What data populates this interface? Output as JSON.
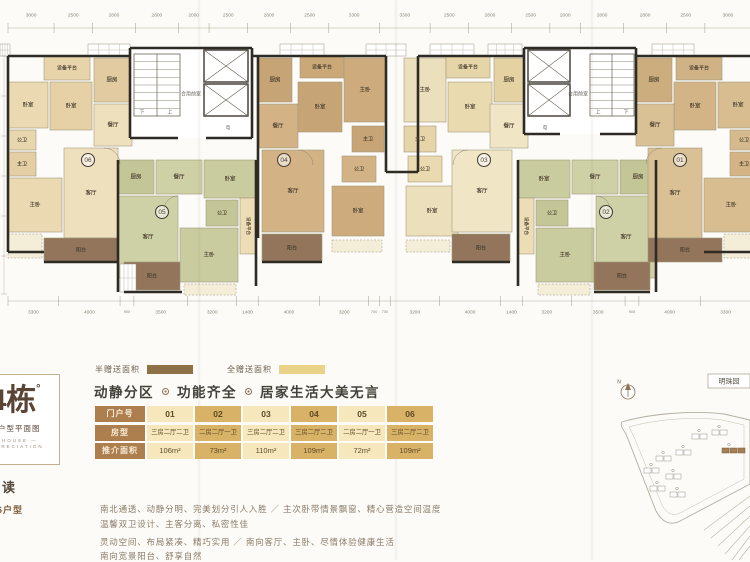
{
  "palette": {
    "accent_brown": "#ad7f4e",
    "table_light": "#f6e7bd",
    "table_dark": "#d8b266",
    "legend_half": "#8f7147",
    "legend_full": "#ead388",
    "balcony": "#92755a",
    "wall": "#2e2a24"
  },
  "legend": {
    "half_label": "半赠送面积",
    "full_label": "全赠送面积"
  },
  "headline": {
    "part1": "动静分区",
    "part2": "功能齐全",
    "part3": "居家生活大美无言"
  },
  "table": {
    "rows": [
      {
        "label": "门户号",
        "cls": "r-no",
        "cells": [
          "01",
          "02",
          "03",
          "04",
          "05",
          "06"
        ]
      },
      {
        "label": "房型",
        "cls": "r-type",
        "cells": [
          "三房二厅二卫",
          "二房二厅一卫",
          "三房二厅二卫",
          "三房二厅二卫",
          "二房二厅一卫",
          "三房二厅二卫"
        ]
      },
      {
        "label": "推介面积",
        "cls": "r-area",
        "cells": [
          "106m²",
          "73m²",
          "110m²",
          "109m²",
          "72m²",
          "109m²"
        ]
      }
    ]
  },
  "logo": {
    "building": "4栋",
    "degree": "°",
    "subtitle": "层户型平面图",
    "en1": "— HOUSE —",
    "en2": "APPRECIATION"
  },
  "notes": {
    "title": "解读",
    "label": "06户型",
    "p1l1": "南北通透、动静分明、完美划分引人入胜 ／ 主次卧带情景飘窗、精心营造空间温度",
    "p1l2": "温馨双卫设计、主客分离、私密性佳",
    "p2l1": "灵动空间、布局紧凑、精巧实用 ／ 南向客厅、主卧、尽情体验健康生活",
    "p2l2": "南向宽景阳台、舒享自然"
  },
  "sitemap": {
    "label": "明珠园",
    "north": "N",
    "outer": "M10,54 C36,46 80,42 112,46 L138,52 L138,116 L70,152 C58,159 50,154 44,143 L14,66 C10,60 8,57 10,54 Z",
    "inner": "M17,59 C40,52 80,48 110,52 L132,57 L132,111 L70,144 C61,149 55,146 50,137 L22,69 Z",
    "roads": [
      [
        92,
        162,
        138,
        128
      ],
      [
        99,
        170,
        138,
        138
      ],
      [
        106,
        178,
        138,
        148
      ],
      [
        113,
        186,
        138,
        158
      ],
      [
        120,
        192,
        138,
        168
      ],
      [
        127,
        192,
        138,
        178
      ]
    ],
    "buildings": [
      {
        "x": 100,
        "y": 62
      },
      {
        "x": 80,
        "y": 66
      },
      {
        "x": 64,
        "y": 82
      },
      {
        "x": 44,
        "y": 88
      },
      {
        "x": 32,
        "y": 100
      },
      {
        "x": 54,
        "y": 106
      },
      {
        "x": 38,
        "y": 118
      },
      {
        "x": 58,
        "y": 124
      },
      {
        "x": 110,
        "y": 80,
        "hl": true
      }
    ],
    "labelbox": {
      "x": 96,
      "y": 6,
      "w": 42,
      "h": 14
    },
    "compass": {
      "cx": 16,
      "cy": 24,
      "r": 7
    }
  },
  "plan": {
    "dims_top": [
      3000,
      2500,
      2800,
      2800,
      2000,
      2500,
      2800,
      2500,
      3300,
      3300,
      2500,
      2800,
      2500,
      2000,
      2800,
      2800,
      2500,
      3000
    ],
    "dims_bottom": [
      3300,
      4000,
      900,
      3500,
      3200,
      1400,
      4000,
      3200,
      700,
      700,
      3200,
      4000,
      1400,
      3200,
      3500,
      900,
      4000,
      3300
    ],
    "rooms": [
      {
        "t": "设备平台",
        "x": 44,
        "y": 56,
        "w": 46,
        "h": 24,
        "f": "#e7d4ab",
        "fs": 5
      },
      {
        "t": "卧室",
        "x": 8,
        "y": 82,
        "w": 40,
        "h": 46,
        "f": "#ebd9b2"
      },
      {
        "t": "卧室",
        "x": 50,
        "y": 82,
        "w": 42,
        "h": 48,
        "f": "#e6d1a6"
      },
      {
        "t": "厨房",
        "x": 94,
        "y": 58,
        "w": 36,
        "h": 44,
        "f": "#e2cba0"
      },
      {
        "t": "餐厅",
        "x": 94,
        "y": 104,
        "w": 38,
        "h": 42,
        "f": "#efe0bd"
      },
      {
        "t": "公卫",
        "x": 8,
        "y": 130,
        "w": 28,
        "h": 20,
        "f": "#e8d6ae",
        "fs": 5
      },
      {
        "t": "主卫",
        "x": 8,
        "y": 152,
        "w": 28,
        "h": 24,
        "f": "#e4cfa4",
        "fs": 5
      },
      {
        "t": "主卧",
        "x": 8,
        "y": 178,
        "w": 54,
        "h": 54,
        "f": "#ebd9b2"
      },
      {
        "t": "客厅",
        "x": 64,
        "y": 148,
        "w": 54,
        "h": 90,
        "f": "#efe0bd"
      },
      {
        "t": "阳台",
        "x": 44,
        "y": 238,
        "w": 74,
        "h": 24,
        "f": "#92755a",
        "fs": 5
      },
      {
        "t": "厨房",
        "x": 118,
        "y": 160,
        "w": 36,
        "h": 34,
        "f": "#c3c697"
      },
      {
        "t": "餐厅",
        "x": 156,
        "y": 160,
        "w": 46,
        "h": 34,
        "f": "#ced1a5"
      },
      {
        "t": "卧室",
        "x": 204,
        "y": 160,
        "w": 52,
        "h": 38,
        "f": "#c9cc9f"
      },
      {
        "t": "公卫",
        "x": 206,
        "y": 200,
        "w": 32,
        "h": 26,
        "f": "#c3c697",
        "fs": 5
      },
      {
        "t": "客厅",
        "x": 118,
        "y": 196,
        "w": 60,
        "h": 82,
        "f": "#ced1a5"
      },
      {
        "t": "主卧",
        "x": 180,
        "y": 228,
        "w": 58,
        "h": 54,
        "f": "#c9cc9f"
      },
      {
        "t": "设备平台",
        "x": 240,
        "y": 198,
        "w": 16,
        "h": 56,
        "f": "#ecddb6",
        "fs": 4.5,
        "rot": 90
      },
      {
        "t": "阳台",
        "x": 124,
        "y": 262,
        "w": 56,
        "h": 28,
        "f": "#92755a",
        "fs": 5
      },
      {
        "t": "厨房",
        "x": 258,
        "y": 58,
        "w": 34,
        "h": 44,
        "f": "#c7a476"
      },
      {
        "t": "餐厅",
        "x": 258,
        "y": 104,
        "w": 40,
        "h": 44,
        "f": "#d3b386"
      },
      {
        "t": "设备平台",
        "x": 300,
        "y": 56,
        "w": 44,
        "h": 22,
        "f": "#caa878",
        "fs": 5
      },
      {
        "t": "卧室",
        "x": 298,
        "y": 82,
        "w": 44,
        "h": 50,
        "f": "#c7a476"
      },
      {
        "t": "主卧",
        "x": 344,
        "y": 58,
        "w": 42,
        "h": 64,
        "f": "#cdab7d"
      },
      {
        "t": "主卫",
        "x": 352,
        "y": 126,
        "w": 32,
        "h": 26,
        "f": "#c7a476",
        "fs": 5
      },
      {
        "t": "公卫",
        "x": 342,
        "y": 156,
        "w": 34,
        "h": 26,
        "f": "#d3b386",
        "fs": 5
      },
      {
        "t": "卧室",
        "x": 332,
        "y": 186,
        "w": 52,
        "h": 50,
        "f": "#cdab7d"
      },
      {
        "t": "客厅",
        "x": 262,
        "y": 150,
        "w": 62,
        "h": 82,
        "f": "#d3b386"
      },
      {
        "t": "阳台",
        "x": 262,
        "y": 234,
        "w": 60,
        "h": 28,
        "f": "#92755a",
        "fs": 5
      },
      {
        "t": "主卧",
        "x": 404,
        "y": 58,
        "w": 42,
        "h": 64,
        "f": "#ece0bc"
      },
      {
        "t": "设备平台",
        "x": 446,
        "y": 56,
        "w": 44,
        "h": 22,
        "f": "#e6d5a8",
        "fs": 5
      },
      {
        "t": "卧室",
        "x": 448,
        "y": 82,
        "w": 44,
        "h": 50,
        "f": "#e9dab0"
      },
      {
        "t": "厨房",
        "x": 494,
        "y": 58,
        "w": 30,
        "h": 44,
        "f": "#e4d2a3"
      },
      {
        "t": "餐厅",
        "x": 490,
        "y": 104,
        "w": 38,
        "h": 44,
        "f": "#f0e6c6"
      },
      {
        "t": "主卫",
        "x": 404,
        "y": 126,
        "w": 32,
        "h": 26,
        "f": "#e6d5a8",
        "fs": 5
      },
      {
        "t": "公卫",
        "x": 408,
        "y": 156,
        "w": 34,
        "h": 26,
        "f": "#e9dab0",
        "fs": 5
      },
      {
        "t": "卧室",
        "x": 406,
        "y": 186,
        "w": 52,
        "h": 50,
        "f": "#ece0bc"
      },
      {
        "t": "客厅",
        "x": 452,
        "y": 150,
        "w": 60,
        "h": 82,
        "f": "#f0e6c6"
      },
      {
        "t": "阳台",
        "x": 452,
        "y": 234,
        "w": 58,
        "h": 28,
        "f": "#92755a",
        "fs": 5
      },
      {
        "t": "卧室",
        "x": 518,
        "y": 160,
        "w": 52,
        "h": 38,
        "f": "#c9cc9f"
      },
      {
        "t": "餐厅",
        "x": 572,
        "y": 160,
        "w": 46,
        "h": 34,
        "f": "#ced1a5"
      },
      {
        "t": "厨房",
        "x": 620,
        "y": 160,
        "w": 36,
        "h": 34,
        "f": "#c3c697"
      },
      {
        "t": "公卫",
        "x": 536,
        "y": 200,
        "w": 32,
        "h": 26,
        "f": "#c3c697",
        "fs": 5
      },
      {
        "t": "主卧",
        "x": 536,
        "y": 228,
        "w": 58,
        "h": 54,
        "f": "#c9cc9f"
      },
      {
        "t": "客厅",
        "x": 596,
        "y": 196,
        "w": 60,
        "h": 82,
        "f": "#ced1a5"
      },
      {
        "t": "设备平台",
        "x": 518,
        "y": 198,
        "w": 16,
        "h": 56,
        "f": "#ecddb6",
        "fs": 4.5,
        "rot": 90
      },
      {
        "t": "阳台",
        "x": 594,
        "y": 262,
        "w": 56,
        "h": 28,
        "f": "#92755a",
        "fs": 5
      },
      {
        "t": "设备平台",
        "x": 676,
        "y": 56,
        "w": 46,
        "h": 24,
        "f": "#cfb285",
        "fs": 5
      },
      {
        "t": "卧室",
        "x": 718,
        "y": 82,
        "w": 40,
        "h": 46,
        "f": "#d7bd90"
      },
      {
        "t": "卧室",
        "x": 674,
        "y": 82,
        "w": 42,
        "h": 48,
        "f": "#d2b487"
      },
      {
        "t": "厨房",
        "x": 636,
        "y": 58,
        "w": 36,
        "h": 44,
        "f": "#ccad7e"
      },
      {
        "t": "餐厅",
        "x": 636,
        "y": 104,
        "w": 38,
        "h": 42,
        "f": "#dac195"
      },
      {
        "t": "公卫",
        "x": 730,
        "y": 130,
        "w": 28,
        "h": 20,
        "f": "#d5ba8d",
        "fs": 5
      },
      {
        "t": "主卫",
        "x": 730,
        "y": 152,
        "w": 28,
        "h": 24,
        "f": "#d2b487",
        "fs": 5
      },
      {
        "t": "主卧",
        "x": 704,
        "y": 178,
        "w": 54,
        "h": 54,
        "f": "#d7bd90"
      },
      {
        "t": "客厅",
        "x": 648,
        "y": 148,
        "w": 54,
        "h": 90,
        "f": "#dac195"
      },
      {
        "t": "阳台",
        "x": 648,
        "y": 238,
        "w": 74,
        "h": 24,
        "f": "#92755a",
        "fs": 5
      }
    ],
    "bays": [
      {
        "x": 8,
        "y": 234,
        "w": 34,
        "h": 24
      },
      {
        "x": 184,
        "y": 284,
        "w": 52,
        "h": 11
      },
      {
        "x": 332,
        "y": 240,
        "w": 50,
        "h": 12
      },
      {
        "x": 406,
        "y": 240,
        "w": 44,
        "h": 12
      },
      {
        "x": 538,
        "y": 284,
        "w": 52,
        "h": 11
      },
      {
        "x": 724,
        "y": 234,
        "w": 34,
        "h": 24
      }
    ],
    "gridboxes": [
      {
        "x": 0,
        "y": 44,
        "w": 10,
        "h": 12
      },
      {
        "x": 88,
        "y": 44,
        "w": 42,
        "h": 12
      },
      {
        "x": 280,
        "y": 44,
        "w": 44,
        "h": 12
      },
      {
        "x": 366,
        "y": 44,
        "w": 40,
        "h": 12
      },
      {
        "x": 430,
        "y": 44,
        "w": 44,
        "h": 12
      },
      {
        "x": 488,
        "y": 44,
        "w": 34,
        "h": 12
      },
      {
        "x": 652,
        "y": 44,
        "w": 42,
        "h": 12
      },
      {
        "x": 120,
        "y": 264,
        "w": 16,
        "h": 28
      }
    ],
    "walls": [
      [
        8,
        56,
        130,
        56
      ],
      [
        8,
        56,
        8,
        252
      ],
      [
        8,
        252,
        44,
        252
      ],
      [
        44,
        262,
        118,
        262
      ],
      [
        130,
        48,
        252,
        48
      ],
      [
        130,
        48,
        130,
        138
      ],
      [
        252,
        48,
        252,
        138
      ],
      [
        130,
        138,
        178,
        138
      ],
      [
        206,
        138,
        252,
        138
      ],
      [
        252,
        56,
        386,
        56
      ],
      [
        258,
        56,
        258,
        238
      ],
      [
        386,
        56,
        386,
        172
      ],
      [
        418,
        56,
        418,
        172
      ],
      [
        418,
        56,
        524,
        56
      ],
      [
        386,
        172,
        418,
        172
      ],
      [
        524,
        48,
        636,
        48
      ],
      [
        524,
        48,
        524,
        134
      ],
      [
        636,
        48,
        636,
        134
      ],
      [
        524,
        134,
        560,
        134
      ],
      [
        600,
        134,
        636,
        134
      ],
      [
        636,
        56,
        750,
        56
      ],
      [
        118,
        160,
        118,
        292
      ],
      [
        124,
        292,
        182,
        292
      ],
      [
        256,
        160,
        256,
        286
      ],
      [
        518,
        160,
        518,
        286
      ],
      [
        656,
        160,
        656,
        292
      ],
      [
        594,
        292,
        650,
        292
      ],
      [
        262,
        262,
        322,
        262
      ],
      [
        452,
        262,
        510,
        262
      ],
      [
        704,
        252,
        750,
        252
      ]
    ],
    "cores": [
      {
        "x": 130,
        "y": 48,
        "w": 122,
        "h": 90,
        "stairs": {
          "x": 134,
          "y": 54,
          "w": 46,
          "h": 62
        },
        "elev": {
          "x": 204,
          "y": 50,
          "w": 44,
          "h": 32
        },
        "labels": [
          {
            "t": "合用前室",
            "x": 191,
            "y": 94,
            "fs": 5
          },
          {
            "t": "下",
            "x": 142,
            "y": 112,
            "fs": 5
          },
          {
            "t": "上",
            "x": 170,
            "y": 112,
            "fs": 5
          },
          {
            "t": "电",
            "x": 228,
            "y": 128,
            "fs": 4.5
          }
        ]
      },
      {
        "x": 524,
        "y": 48,
        "w": 112,
        "h": 86,
        "stairs": {
          "x": 590,
          "y": 54,
          "w": 44,
          "h": 62
        },
        "elev": {
          "x": 528,
          "y": 50,
          "w": 42,
          "h": 32
        },
        "labels": [
          {
            "t": "合用前室",
            "x": 578,
            "y": 94,
            "fs": 5
          },
          {
            "t": "上",
            "x": 598,
            "y": 112,
            "fs": 5
          },
          {
            "t": "下",
            "x": 626,
            "y": 112,
            "fs": 5
          },
          {
            "t": "电",
            "x": 545,
            "y": 128,
            "fs": 4.5
          }
        ]
      }
    ],
    "arcs": [
      "M104,148 A16,16 0 0 1 120,164",
      "M178,196 A14,14 0 0 0 164,210",
      "M298,150 A15,15 0 0 1 313,165",
      "M468,150 A15,15 0 0 0 453,165",
      "M596,196 A14,14 0 0 1 610,210",
      "M662,148 A16,16 0 0 0 646,164"
    ],
    "units": [
      {
        "n": "06",
        "x": 88,
        "y": 160
      },
      {
        "n": "05",
        "x": 162,
        "y": 212
      },
      {
        "n": "04",
        "x": 284,
        "y": 160
      },
      {
        "n": "03",
        "x": 484,
        "y": 160
      },
      {
        "n": "02",
        "x": 606,
        "y": 212
      },
      {
        "n": "01",
        "x": 680,
        "y": 160
      }
    ]
  }
}
